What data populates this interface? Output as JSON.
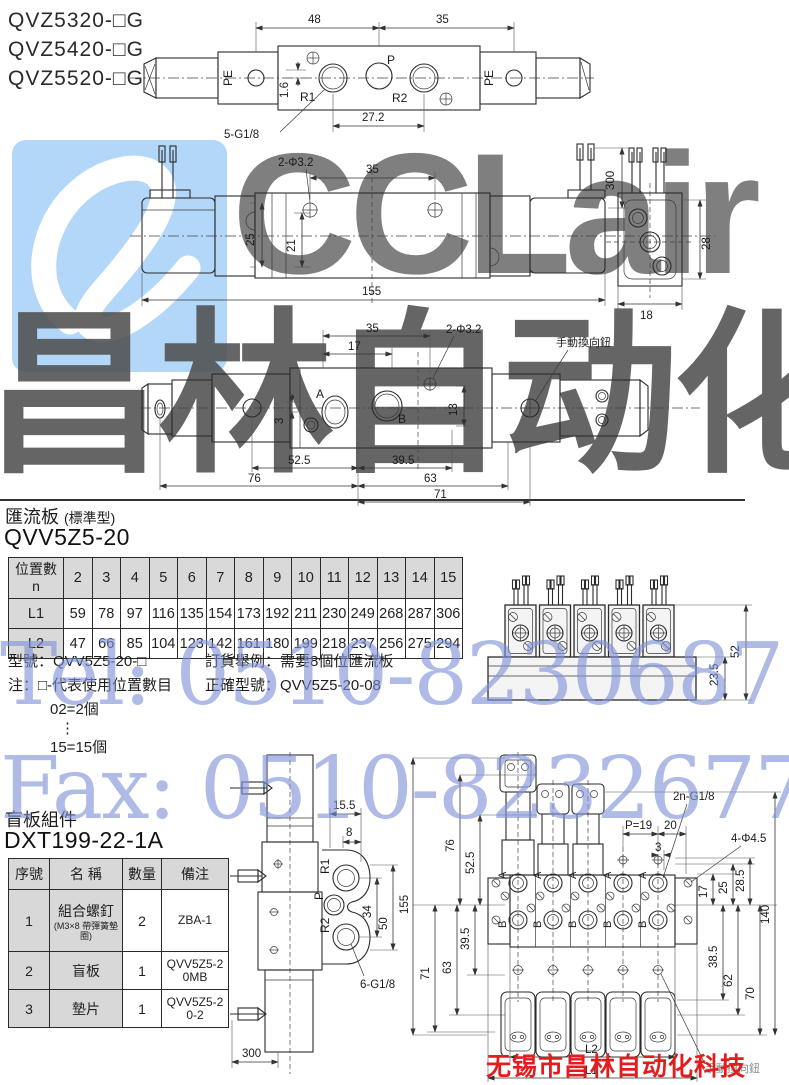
{
  "header": {
    "models": [
      "QVZ5320-□G",
      "QVZ5420-□G",
      "QVZ5520-□G"
    ]
  },
  "watermark": {
    "logo": "CCLair",
    "cn": "昌林自动化",
    "tel": "Tel: 0510-82306871",
    "fax": "Fax: 0510-82326771",
    "company": "无锡市昌林自动化科技",
    "accent_blue": "#7f93d8",
    "accent_red": "#e31d1d",
    "tile_blue": "#b3d7f8"
  },
  "top_view": {
    "pe_left": "PE",
    "pe_right": "PE",
    "r1": "R1",
    "p": "P",
    "r2": "R2",
    "d48": "48",
    "d35": "35",
    "d1_6": "1.6",
    "d27_2": "27.2",
    "thread": "5-G1/8"
  },
  "front_view": {
    "holes": "2-Φ3.2",
    "d35": "35",
    "d300": "300",
    "d25": "25",
    "d21": "21",
    "d155": "155",
    "d28": "28",
    "d18": "18"
  },
  "plan_view": {
    "d35": "35",
    "d17": "17",
    "holes": "2-Φ3.2",
    "manual": "手動換向鈕",
    "a": "A",
    "b": "B",
    "d3": "3",
    "d13": "13",
    "d52_5": "52.5",
    "d39_5": "39.5",
    "d76": "76",
    "d63": "63",
    "d71": "71"
  },
  "manifold": {
    "title": "匯流板",
    "title_note": "(標準型)",
    "model": "QVV5Z5-20",
    "table": {
      "corner_top": "位置數",
      "corner_bottom": "n",
      "cols": [
        "2",
        "3",
        "4",
        "5",
        "6",
        "7",
        "8",
        "9",
        "10",
        "11",
        "12",
        "13",
        "14",
        "15"
      ],
      "l1_label": "L1",
      "l1": [
        "59",
        "78",
        "97",
        "116",
        "135",
        "154",
        "173",
        "192",
        "211",
        "230",
        "249",
        "268",
        "287",
        "306"
      ],
      "l2_label": "L2",
      "l2": [
        "47",
        "66",
        "85",
        "104",
        "123",
        "142",
        "161",
        "180",
        "199",
        "218",
        "237",
        "256",
        "275",
        "294"
      ]
    },
    "note_model": "型號：QVV5Z5-20-□",
    "note_note": "注：□-代表使用位置數目",
    "note_eg1": "02=2個",
    "note_dots": "⋮",
    "note_eg2": "15=15個",
    "order_line1": "訂貨舉例：需要8個位匯流板",
    "order_line2": "正確型號：QVV5Z5-20-08",
    "d52": "52",
    "d23_5": "23.5"
  },
  "blank_plate": {
    "title": "盲板組件",
    "model": "DXT199-22-1A",
    "table": {
      "h_no": "序號",
      "h_name": "名  稱",
      "h_qty": "數量",
      "h_note": "備注",
      "rows": [
        {
          "no": "1",
          "name": "組合螺釘",
          "sub": "(M3×8 帶彈簧墊圈)",
          "qty": "2",
          "note": "ZBA-1"
        },
        {
          "no": "2",
          "name": "盲板",
          "sub": "",
          "qty": "1",
          "note": "QVV5Z5-20MB"
        },
        {
          "no": "3",
          "name": "墊片",
          "sub": "",
          "qty": "1",
          "note": "QVV5Z5-20-2"
        }
      ]
    }
  },
  "side_view": {
    "d15_5": "15.5",
    "d8": "8",
    "r1": "R1",
    "p": "P",
    "r2": "R2",
    "d34": "34",
    "d50": "50",
    "thread": "6-G1/8",
    "d300": "300"
  },
  "manifold_top": {
    "v155": "155",
    "v76": "76",
    "v52_5": "52.5",
    "v71": "71",
    "v63": "63",
    "v39_5": "39.5",
    "thread": "2n-G1/8",
    "p19": "P=19",
    "d20": "20",
    "d3": "3",
    "holes": "4-Φ4.5",
    "d17": "17",
    "d25": "25",
    "d28_5": "28.5",
    "d38_5": "38.5",
    "d62": "62",
    "d70": "70",
    "d140": "140",
    "a": "A",
    "b": "B",
    "l2": "L2",
    "l1": "L1",
    "manual": "手動換向鈕"
  }
}
